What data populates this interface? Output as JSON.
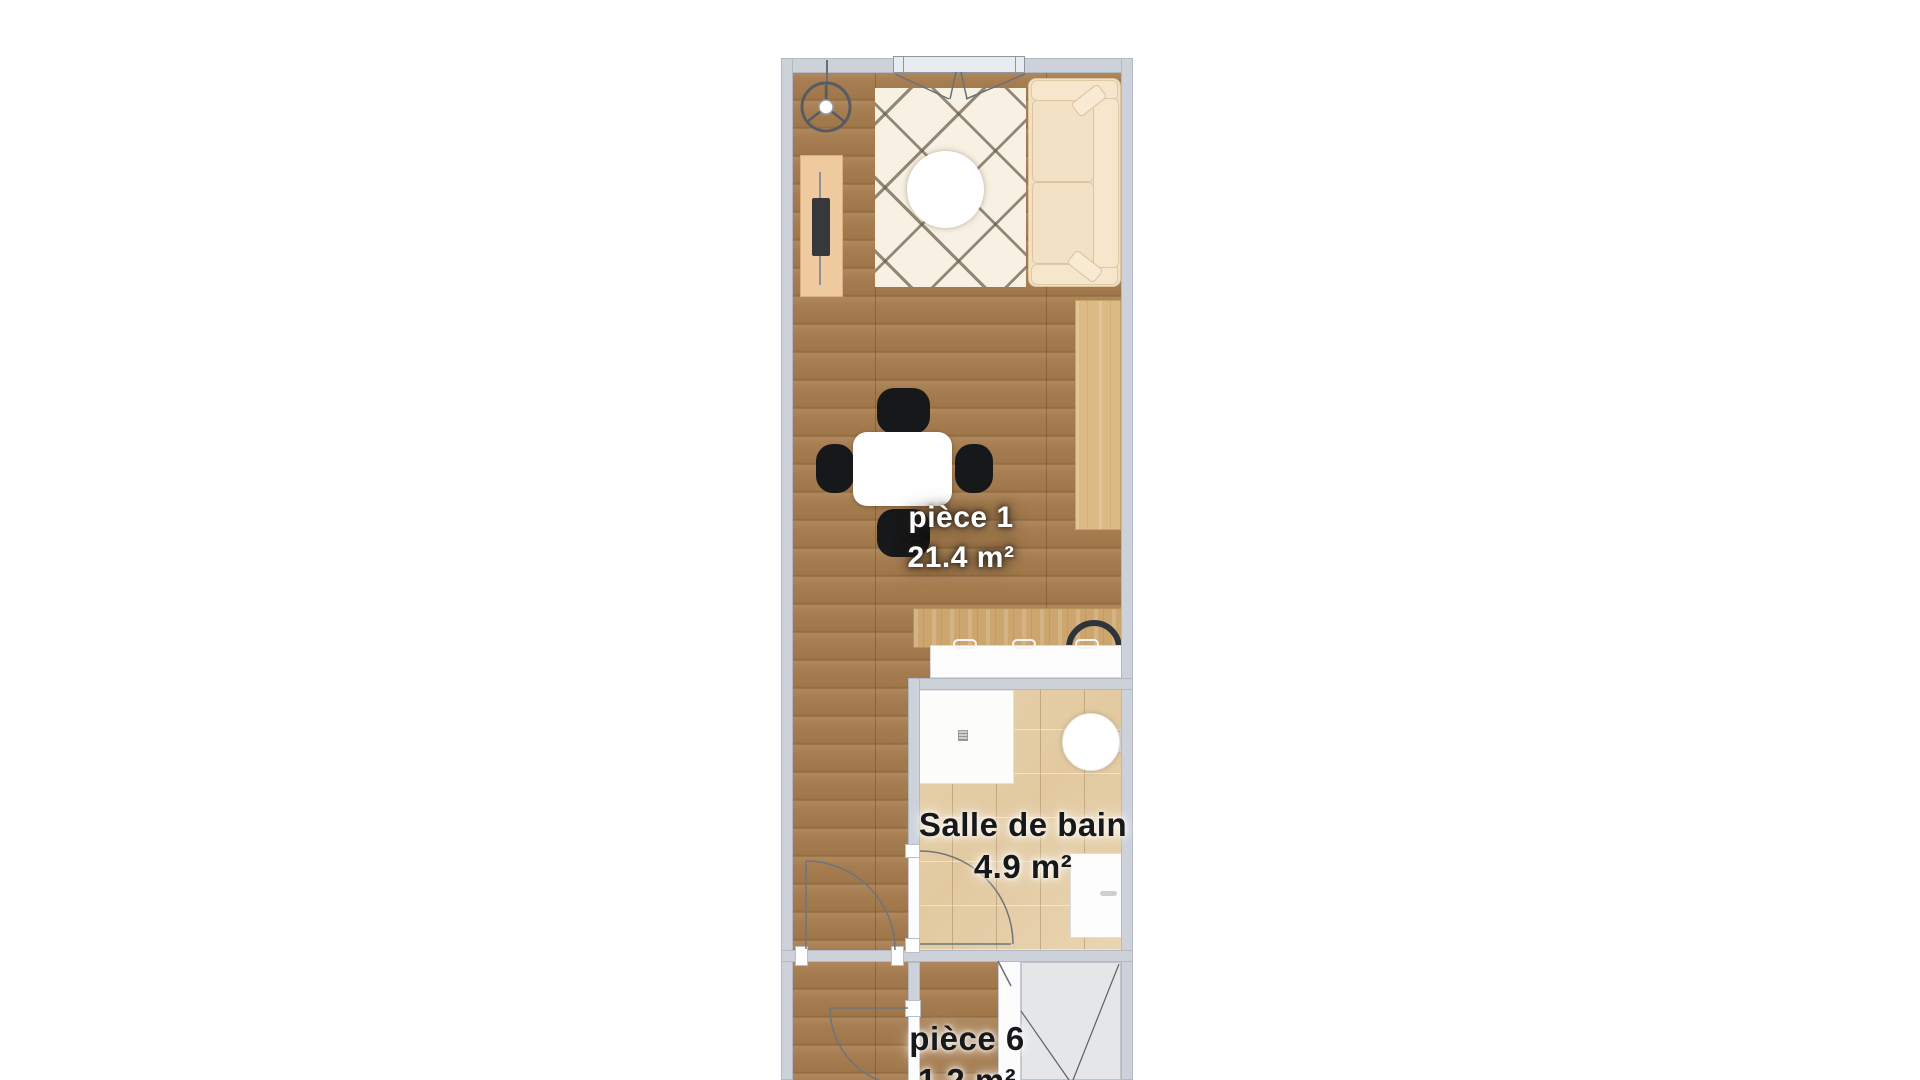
{
  "floorplan": {
    "rooms": [
      {
        "name": "pièce 1",
        "area": "21.4 m²",
        "label_style": "light"
      },
      {
        "name": "Salle de bain",
        "area": "4.9 m²",
        "label_style": "dark"
      },
      {
        "name": "pièce 6",
        "area": "1.2 m²",
        "label_style": "dark"
      }
    ],
    "furniture": [
      "ceiling-fan",
      "tv-sideboard",
      "tv",
      "berber-rug",
      "round-coffee-table",
      "sofa",
      "wall-desk",
      "dining-table",
      "dining-chair",
      "kitchen-counter",
      "kitchen-sink",
      "shower",
      "washbasin",
      "washing-machine",
      "staircase"
    ],
    "colors": {
      "wall": "#cdd2da",
      "floor_wood": "#a47b50",
      "counter_wood": "#cda66f",
      "bathroom_tile": "#e6d0ab",
      "rug": "#f7f1e3",
      "sofa": "#f2e0c4",
      "sideboard": "#eeca9e",
      "chair": "#17181a",
      "stair_area": "#e5e6e8",
      "exterior": "#ffffff"
    }
  }
}
